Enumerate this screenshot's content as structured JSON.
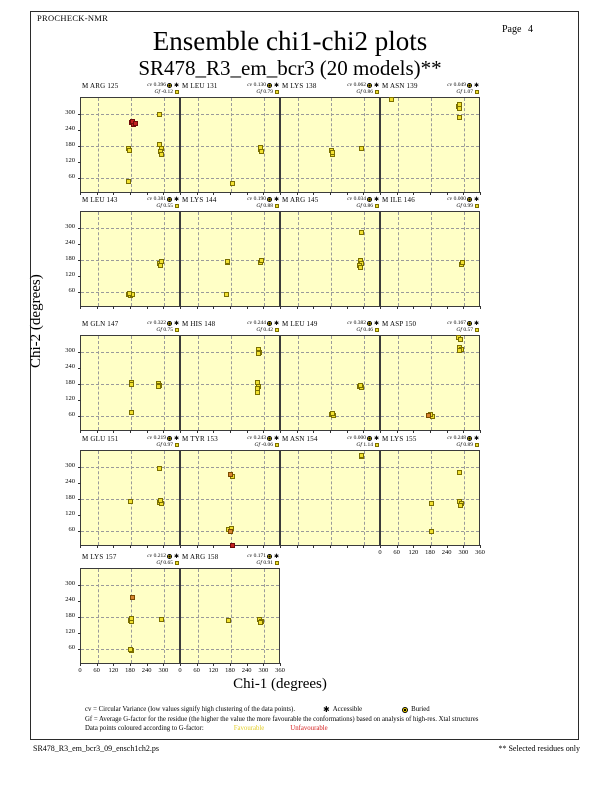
{
  "page": {
    "app_name": "PROCHECK-NMR",
    "page_label": "Page  4",
    "title_line1": "Ensemble chi1-chi2 plots",
    "title_line2": "SR478_R3_em_bcr3 (20 models)**",
    "filename": "SR478_R3_em_bcr3_09_ensch1ch2.ps",
    "selected_note": "** Selected residues only"
  },
  "legend": {
    "cv_line": "cv = Circular Variance (low values signify high clustering of the data points).",
    "accessible_label": "Accessible",
    "buried_label": "Buried",
    "gf_line": "Gf = Average G-factor for the residue (the higher the value the more favourable the conformations)  based on analysis of high-res. Xtal structures",
    "colour_line_prefix": "Data points coloured according to G-factor:",
    "favourable_label": "Favourable",
    "unfavourable_label": "Unfavourable"
  },
  "colors": {
    "plot_bg": "#FFFFC6",
    "frame": "#3b3b3b",
    "grid": "#9a9a9a",
    "favourable": "#F2E130",
    "mid": "#D88430",
    "unfavourable": "#C42020",
    "square_border_y": "#7a6f00",
    "square_border_o": "#7a4a00",
    "square_border_r": "#6e0a0a",
    "legend_favourable_text": "#E3CE2A",
    "legend_unfavourable_text": "#D42020"
  },
  "chart_data": {
    "type": "scatter",
    "xlabel": "Chi-1 (degrees)",
    "ylabel": "Chi-2 (degrees)",
    "xlim": [
      0,
      360
    ],
    "ylim": [
      0,
      360
    ],
    "x_ticks": [
      0,
      60,
      120,
      180,
      240,
      300,
      360
    ],
    "y_ticks": [
      60,
      120,
      180,
      240,
      300
    ],
    "grid_lines_deg": [
      60,
      180,
      300
    ],
    "cv_prefix": "cv",
    "gf_prefix": "Gf",
    "point_shape": "square",
    "plots": [
      {
        "label": "M ARG 125",
        "cv": "0.396",
        "gf": "-0.12",
        "row": 0,
        "col": 0,
        "x_labels": "none",
        "points": [
          [
            170,
            170,
            "y"
          ],
          [
            176,
            163,
            "y"
          ],
          [
            283,
            300,
            "y"
          ],
          [
            283,
            185,
            "y"
          ],
          [
            288,
            172,
            "y"
          ],
          [
            285,
            160,
            "y"
          ],
          [
            290,
            150,
            "y"
          ],
          [
            172,
            48,
            "y"
          ],
          [
            182,
            268,
            "r"
          ],
          [
            190,
            262,
            "r"
          ],
          [
            186,
            272,
            "r"
          ],
          [
            196,
            266,
            "r"
          ]
        ]
      },
      {
        "label": "M LEU 131",
        "cv": "0.130",
        "gf": "0.79",
        "row": 0,
        "col": 1,
        "x_labels": "none",
        "points": [
          [
            285,
            168,
            "y"
          ],
          [
            290,
            160,
            "y"
          ],
          [
            287,
            174,
            "y"
          ],
          [
            184,
            40,
            "y"
          ]
        ]
      },
      {
        "label": "M LYS 138",
        "cv": "0.062",
        "gf": "0.86",
        "row": 0,
        "col": 2,
        "x_labels": "none",
        "points": [
          [
            182,
            162,
            "y"
          ],
          [
            185,
            150,
            "y"
          ],
          [
            184,
            156,
            "y"
          ],
          [
            288,
            170,
            "y"
          ]
        ]
      },
      {
        "label": "M ASN 139",
        "cv": "0.049",
        "gf": "1.07",
        "row": 0,
        "col": 3,
        "x_labels": "none",
        "points": [
          [
            36,
            356,
            "y"
          ],
          [
            278,
            330,
            "y"
          ],
          [
            283,
            336,
            "y"
          ],
          [
            281,
            322,
            "y"
          ],
          [
            284,
            288,
            "y"
          ]
        ]
      },
      {
        "label": "M LEU 143",
        "cv": "0.381",
        "gf": "0.55",
        "row": 1,
        "col": 0,
        "x_labels": "none",
        "points": [
          [
            283,
            168,
            "y"
          ],
          [
            288,
            175,
            "y"
          ],
          [
            286,
            158,
            "y"
          ],
          [
            170,
            50,
            "y"
          ],
          [
            178,
            46,
            "y"
          ],
          [
            186,
            50,
            "y"
          ],
          [
            174,
            54,
            "y"
          ]
        ]
      },
      {
        "label": "M LYS 144",
        "cv": "0.190",
        "gf": "0.88",
        "row": 1,
        "col": 1,
        "x_labels": "none",
        "points": [
          [
            166,
            170,
            "y"
          ],
          [
            169,
            176,
            "y"
          ],
          [
            285,
            172,
            "y"
          ],
          [
            288,
            178,
            "y"
          ],
          [
            163,
            50,
            "y"
          ]
        ]
      },
      {
        "label": "M ARG 145",
        "cv": "0.034",
        "gf": "0.86",
        "row": 1,
        "col": 2,
        "x_labels": "none",
        "points": [
          [
            288,
            282,
            "y"
          ],
          [
            285,
            178,
            "y"
          ],
          [
            288,
            168,
            "y"
          ],
          [
            284,
            160,
            "y"
          ],
          [
            287,
            152,
            "y"
          ]
        ]
      },
      {
        "label": "M ILE 146",
        "cv": "0.000",
        "gf": "0.99",
        "row": 1,
        "col": 3,
        "x_labels": "none",
        "points": [
          [
            290,
            164,
            "y"
          ],
          [
            292,
            169,
            "y"
          ]
        ]
      },
      {
        "label": "M GLN 147",
        "cv": "0.322",
        "gf": "0.75",
        "row": 2,
        "col": 0,
        "x_labels": "none",
        "points": [
          [
            180,
            186,
            "y"
          ],
          [
            183,
            180,
            "y"
          ],
          [
            278,
            182,
            "y"
          ],
          [
            283,
            176,
            "y"
          ],
          [
            280,
            170,
            "y"
          ],
          [
            181,
            72,
            "y"
          ]
        ]
      },
      {
        "label": "M HIS 148",
        "cv": "0.244",
        "gf": "0.42",
        "row": 2,
        "col": 1,
        "x_labels": "none",
        "points": [
          [
            279,
            310,
            "y"
          ],
          [
            281,
            300,
            "y"
          ],
          [
            278,
            294,
            "y"
          ],
          [
            276,
            185,
            "y"
          ],
          [
            278,
            172,
            "y"
          ],
          [
            275,
            162,
            "y"
          ],
          [
            277,
            150,
            "y"
          ]
        ]
      },
      {
        "label": "M LEU 149",
        "cv": "0.382",
        "gf": "0.46",
        "row": 2,
        "col": 2,
        "x_labels": "none",
        "points": [
          [
            283,
            170,
            "y"
          ],
          [
            291,
            166,
            "y"
          ],
          [
            287,
            174,
            "y"
          ],
          [
            180,
            66,
            "y"
          ],
          [
            188,
            62,
            "y"
          ],
          [
            184,
            70,
            "y"
          ]
        ]
      },
      {
        "label": "M ASP 150",
        "cv": "0.167",
        "gf": "0.57",
        "row": 2,
        "col": 3,
        "x_labels": "none",
        "points": [
          [
            280,
            354,
            "y"
          ],
          [
            286,
            348,
            "y"
          ],
          [
            282,
            318,
            "y"
          ],
          [
            288,
            310,
            "y"
          ],
          [
            284,
            304,
            "y"
          ],
          [
            185,
            60,
            "y"
          ],
          [
            178,
            66,
            "y"
          ],
          [
            172,
            62,
            "o"
          ]
        ]
      },
      {
        "label": "M GLU 151",
        "cv": "0.219",
        "gf": "0.97",
        "row": 3,
        "col": 0,
        "x_labels": "none",
        "points": [
          [
            284,
            296,
            "y"
          ],
          [
            178,
            170,
            "y"
          ],
          [
            281,
            168,
            "y"
          ],
          [
            288,
            162,
            "y"
          ],
          [
            285,
            174,
            "y"
          ]
        ]
      },
      {
        "label": "M TYR 153",
        "cv": "0.243",
        "gf": "-0.06",
        "row": 3,
        "col": 1,
        "x_labels": "none",
        "points": [
          [
            184,
            266,
            "y"
          ],
          [
            178,
            272,
            "o"
          ],
          [
            172,
            66,
            "y"
          ],
          [
            182,
            68,
            "y"
          ],
          [
            178,
            60,
            "o"
          ],
          [
            184,
            4,
            "r"
          ]
        ]
      },
      {
        "label": "M ASN 154",
        "cv": "0.000",
        "gf": "1.14",
        "row": 3,
        "col": 2,
        "x_labels": "none",
        "points": [
          [
            288,
            338,
            "y"
          ],
          [
            291,
            342,
            "y"
          ]
        ]
      },
      {
        "label": "M LYS 155",
        "cv": "0.248",
        "gf": "0.89",
        "row": 3,
        "col": 3,
        "x_labels": "full",
        "points": [
          [
            281,
            280,
            "y"
          ],
          [
            180,
            165,
            "y"
          ],
          [
            282,
            170,
            "y"
          ],
          [
            288,
            162,
            "y"
          ],
          [
            285,
            154,
            "y"
          ],
          [
            182,
            57,
            "y"
          ]
        ]
      },
      {
        "label": "M LYS 157",
        "cv": "0.212",
        "gf": "0.65",
        "row": 4,
        "col": 0,
        "x_labels": "no-last",
        "points": [
          [
            184,
            255,
            "o"
          ],
          [
            177,
            168,
            "y"
          ],
          [
            183,
            162,
            "y"
          ],
          [
            180,
            174,
            "y"
          ],
          [
            288,
            170,
            "y"
          ],
          [
            182,
            54,
            "y"
          ],
          [
            178,
            58,
            "y"
          ]
        ]
      },
      {
        "label": "M ARG 158",
        "cv": "0.171",
        "gf": "0.91",
        "row": 4,
        "col": 1,
        "x_labels": "full",
        "points": [
          [
            170,
            168,
            "y"
          ],
          [
            284,
            172,
            "y"
          ],
          [
            290,
            165,
            "y"
          ],
          [
            287,
            158,
            "y"
          ]
        ]
      }
    ]
  }
}
